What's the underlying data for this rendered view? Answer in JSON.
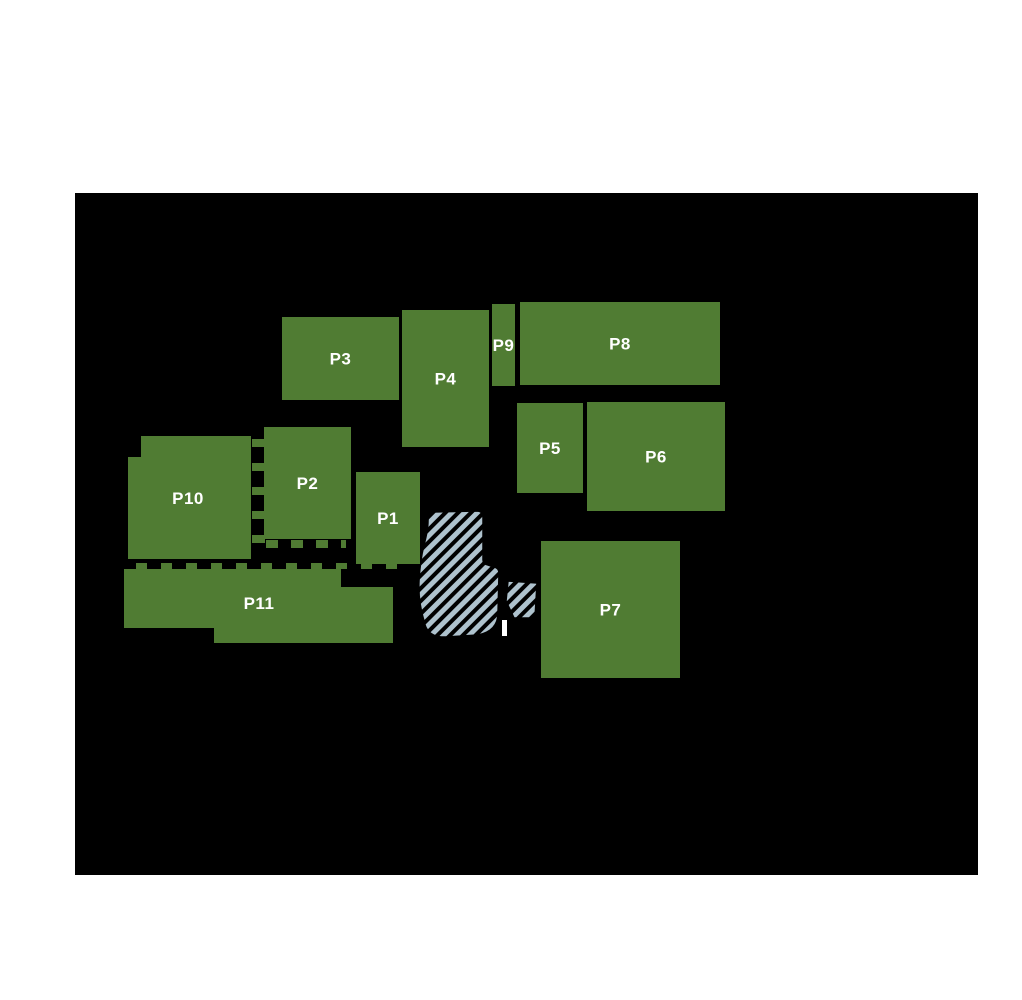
{
  "page": {
    "background_color": "#ffffff"
  },
  "map": {
    "background_color": "#000000",
    "parcel_fill_color": "#507c33",
    "parcel_label_color": "#ffffff",
    "hatch_fill_color": "#aec2cd",
    "hatch_stripe_color": "#000000",
    "parcels": [
      {
        "label": "P1",
        "shape": "rect",
        "x": 281,
        "y": 279,
        "w": 64,
        "h": 92
      },
      {
        "label": "P2",
        "shape": "rect",
        "x": 189,
        "y": 234,
        "w": 87,
        "h": 112
      },
      {
        "label": "P3",
        "shape": "rect",
        "x": 207,
        "y": 124,
        "w": 117,
        "h": 83
      },
      {
        "label": "P4",
        "shape": "rect",
        "x": 327,
        "y": 117,
        "w": 87,
        "h": 137
      },
      {
        "label": "P5",
        "shape": "rect",
        "x": 442,
        "y": 210,
        "w": 66,
        "h": 90
      },
      {
        "label": "P6",
        "shape": "rect",
        "x": 512,
        "y": 209,
        "w": 138,
        "h": 109
      },
      {
        "label": "P7",
        "shape": "rect",
        "x": 466,
        "y": 348,
        "w": 139,
        "h": 137
      },
      {
        "label": "P8",
        "shape": "rect",
        "x": 445,
        "y": 109,
        "w": 200,
        "h": 83
      },
      {
        "label": "P9",
        "shape": "rect",
        "x": 417,
        "y": 111,
        "w": 23,
        "h": 82
      },
      {
        "label": "P10",
        "shape": "polygon",
        "points": "66,243 176,243 176,366 53,366 53,264 66,264",
        "label_x": 113,
        "label_y": 305
      },
      {
        "label": "P11",
        "shape": "polygon",
        "points": "49,376 266,376 266,394 318,394 318,450 139,450 139,435 49,435",
        "label_x": 184,
        "label_y": 410
      }
    ],
    "hatched_areas": [
      {
        "name": "hatched-area-main",
        "path": "M358,319 L402,318 Q408,318 408,325 L408,367 Q408,371 413,372 L419,374 Q424,375 424,380 L423,420 Q423,438 403,442 L371,444 Q352,445 349,428 Q343,408 344,388 Q345,368 349,352 Q353,337 353,328 Q353,319 358,319 Z"
      },
      {
        "name": "hatched-area-small",
        "path": "M433,388 L462,390 L460,425 L439,425 L431,408 Z"
      }
    ],
    "boundary_dashes": [
      {
        "orientation": "h",
        "x1": 61,
        "x2": 328,
        "y": 370,
        "thickness": 6,
        "dash": 11,
        "gap": 14
      },
      {
        "orientation": "v",
        "y1": 246,
        "y2": 360,
        "x": 177,
        "thickness": 13,
        "dash": 8,
        "gap": 16
      },
      {
        "orientation": "h",
        "x1": 191,
        "x2": 271,
        "y": 347,
        "thickness": 8,
        "dash": 12,
        "gap": 13
      }
    ],
    "white_marker": {
      "x": 427,
      "y": 427,
      "w": 5,
      "h": 16,
      "color": "#ffffff"
    }
  }
}
